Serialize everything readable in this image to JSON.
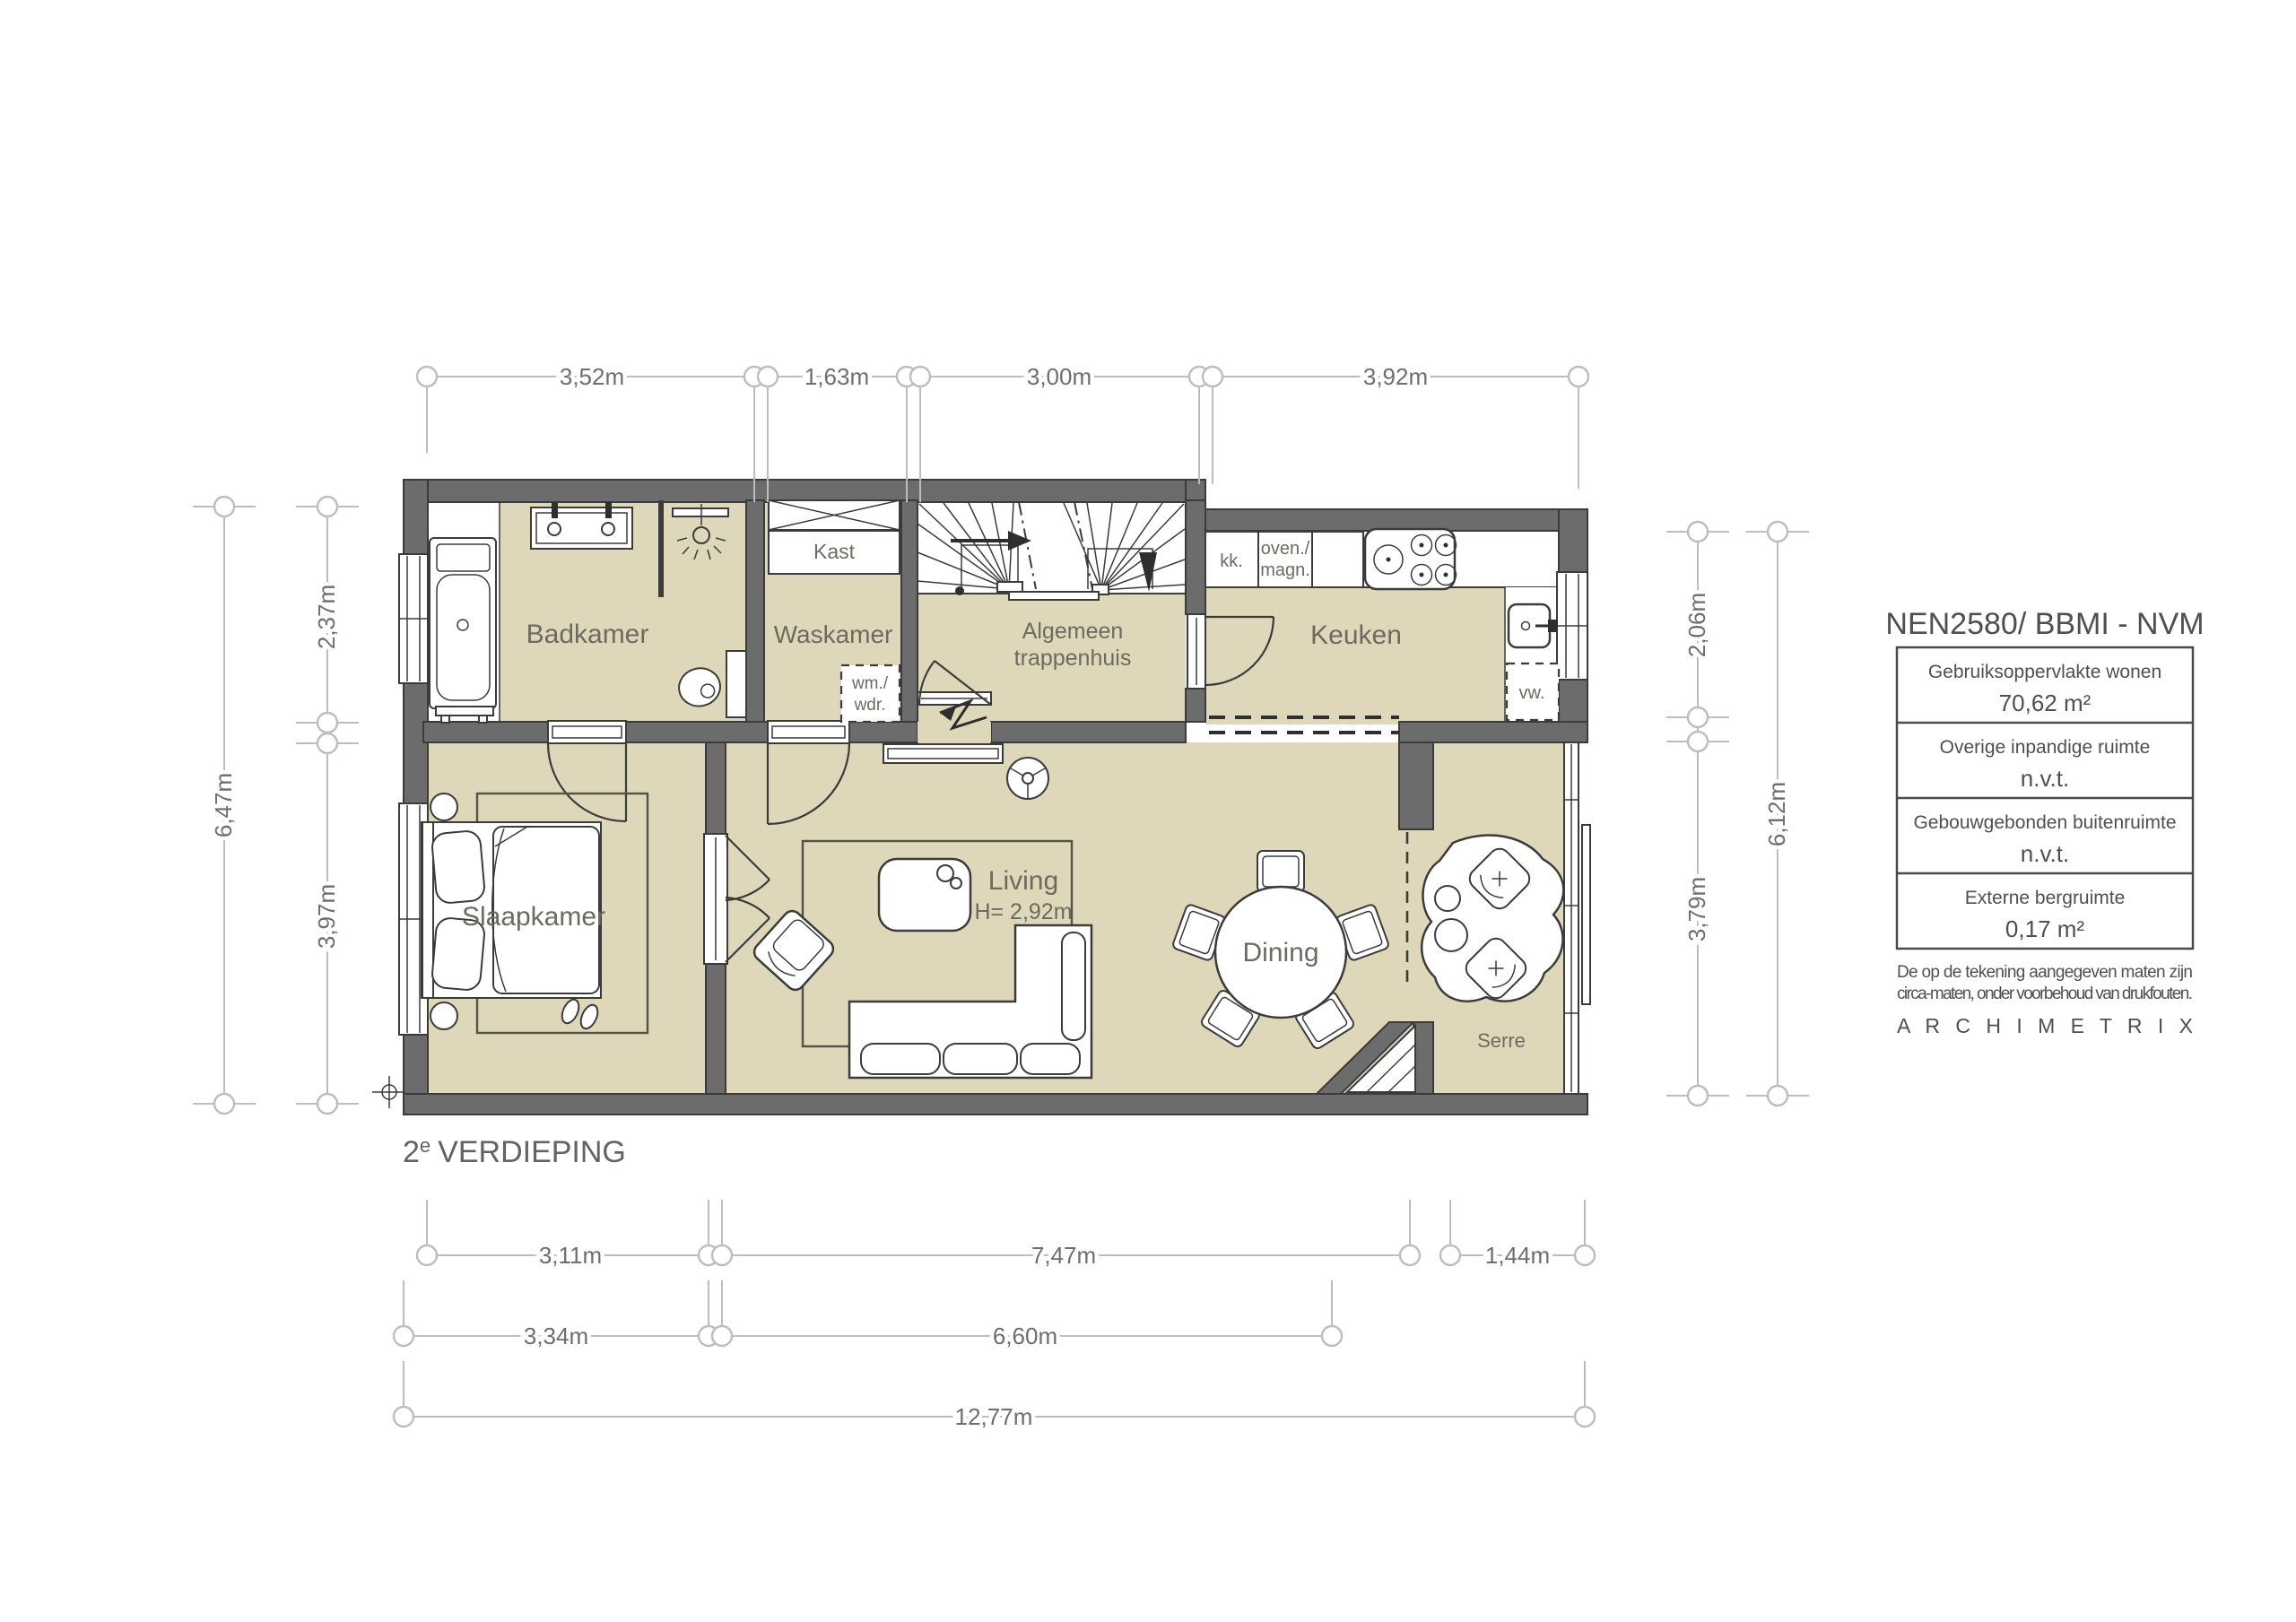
{
  "floor_label": {
    "number": "2",
    "sup": "e",
    "text": "VERDIEPING"
  },
  "rooms": {
    "badkamer": "Badkamer",
    "waskamer": "Waskamer",
    "trappenhuis1": "Algemeen",
    "trappenhuis2": "trappenhuis",
    "keuken": "Keuken",
    "slaapkamer": "Slaapkamer",
    "living": "Living",
    "living_height": "H= 2,92m",
    "dining": "Dining",
    "serre": "Serre"
  },
  "fixtures": {
    "kast": "Kast",
    "wm1": "wm./",
    "wm2": "wdr.",
    "kk": "kk.",
    "oven1": "oven./",
    "oven2": "magn.",
    "vw": "vw."
  },
  "dims": {
    "top": [
      "3,52m",
      "1,63m",
      "3,00m",
      "3,92m"
    ],
    "left": {
      "total": "6,47m",
      "top": "2,37m",
      "bottom": "3,97m"
    },
    "right": {
      "top": "2,06m",
      "total": "6,12m",
      "bottom": "3,79m"
    },
    "bottom": {
      "row1": [
        "3,11m",
        "7,47m",
        "1,44m"
      ],
      "row2": [
        "3,34m",
        "6,60m"
      ],
      "total": "12,77m"
    }
  },
  "legend": {
    "title": "NEN2580/ BBMI - NVM",
    "rows": [
      {
        "label": "Gebruiksoppervlakte wonen",
        "value": "70,62 m²"
      },
      {
        "label": "Overige inpandige ruimte",
        "value": "n.v.t."
      },
      {
        "label": "Gebouwgebonden buitenruimte",
        "value": "n.v.t."
      },
      {
        "label": "Externe bergruimte",
        "value": "0,17 m²"
      }
    ],
    "disclaimer1": "De op de tekening aangegeven maten zijn",
    "disclaimer2": "circa-maten, onder voorbehoud van drukfouten.",
    "brand": "A R C H I M E T R I X"
  },
  "colors": {
    "floor": "#ded7ba",
    "wall": "#6c6c6c",
    "line": "#3b3b3b",
    "dim": "#bdbdbd",
    "text": "#6e6e6e"
  }
}
